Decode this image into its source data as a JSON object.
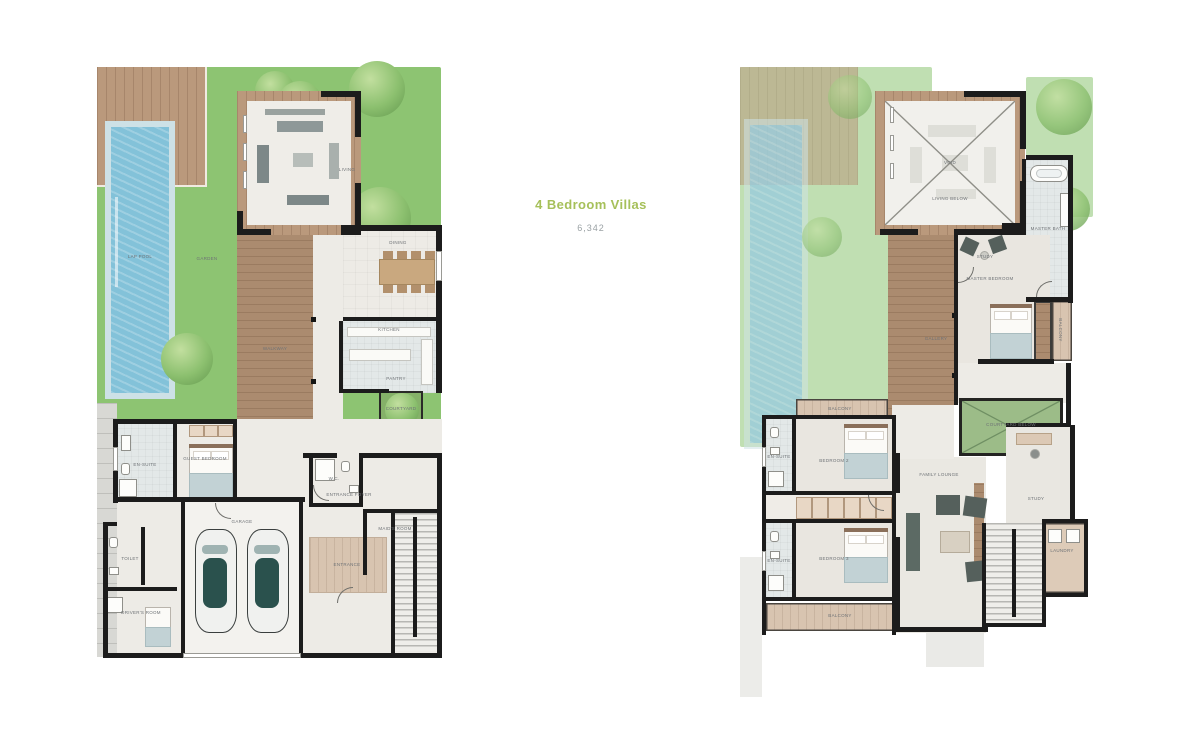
{
  "header": {
    "title": "4 Bedroom Villas",
    "subtitle": "6,342"
  },
  "colors": {
    "page": "#ffffff",
    "accent": "#a6c05a",
    "sublabel": "#9aa1a4",
    "label": "#6e7276",
    "garden": "#8dc472",
    "garden_faded": "#b9d8a8",
    "pool": "#83c2d9",
    "pool_rim": "#cde1e6",
    "wood": "#ba997c",
    "wood_dark": "#ab8b6f",
    "wall": "#1c1c1c",
    "floor": "#edebe6",
    "floor_cool": "#e3e8e8",
    "tan": "#d8c4b0",
    "court": "#85b169",
    "car_roof": "#2a514d"
  },
  "plans": [
    {
      "id": "plan-ground",
      "name": "ground-floor-plan",
      "labels": [
        {
          "text": "LAP POOL",
          "x": 12.5,
          "y": 32.0
        },
        {
          "text": "GARDEN",
          "x": 31.9,
          "y": 32.3
        },
        {
          "text": "LIVING",
          "x": 72.5,
          "y": 17.3
        },
        {
          "text": "DINING",
          "x": 87.2,
          "y": 29.6
        },
        {
          "text": "KITCHEN",
          "x": 84.6,
          "y": 44.3
        },
        {
          "text": "PANTRY",
          "x": 86.7,
          "y": 52.5
        },
        {
          "text": "COURTYARD",
          "x": 88.1,
          "y": 57.6
        },
        {
          "text": "WALKWAY",
          "x": 51.6,
          "y": 47.5
        },
        {
          "text": "GUEST BEDROOM",
          "x": 31.3,
          "y": 66.0
        },
        {
          "text": "EN-SUITE",
          "x": 13.9,
          "y": 67.0
        },
        {
          "text": "GARAGE",
          "x": 42.0,
          "y": 76.6
        },
        {
          "text": "ENTRANCE FOYER",
          "x": 73.0,
          "y": 72.1
        },
        {
          "text": "ENTRANCE",
          "x": 72.5,
          "y": 83.8
        },
        {
          "text": "W.C.",
          "x": 68.7,
          "y": 69.4
        },
        {
          "text": "MAID'S ROOM",
          "x": 86.4,
          "y": 77.8
        },
        {
          "text": "TOILET",
          "x": 9.6,
          "y": 82.8
        },
        {
          "text": "DRIVER'S ROOM",
          "x": 12.8,
          "y": 91.9
        }
      ]
    },
    {
      "id": "plan-first",
      "name": "first-floor-plan",
      "labels": [
        {
          "text": "VOID",
          "x": 59.5,
          "y": 16.2
        },
        {
          "text": "LIVING BELOW",
          "x": 59.5,
          "y": 22.2
        },
        {
          "text": "MASTER BATH",
          "x": 87.3,
          "y": 27.3
        },
        {
          "text": "STUDY",
          "x": 69.4,
          "y": 32.0
        },
        {
          "text": "MASTER BEDROOM",
          "x": 70.8,
          "y": 35.7
        },
        {
          "text": "BALCONY",
          "x": 90.7,
          "y": 44.3,
          "rot": 90
        },
        {
          "text": "GALLERY",
          "x": 55.5,
          "y": 45.8
        },
        {
          "text": "COURTYARD BELOW",
          "x": 76.8,
          "y": 60.3
        },
        {
          "text": "BALCONY",
          "x": 28.3,
          "y": 57.6
        },
        {
          "text": "BEDROOM 2",
          "x": 26.6,
          "y": 66.3
        },
        {
          "text": "EN-SUITE",
          "x": 11.0,
          "y": 65.7
        },
        {
          "text": "BEDROOM 3",
          "x": 26.6,
          "y": 82.8
        },
        {
          "text": "EN-SUITE",
          "x": 11.0,
          "y": 83.2
        },
        {
          "text": "FAMILY LOUNGE",
          "x": 56.4,
          "y": 68.7
        },
        {
          "text": "STUDY",
          "x": 83.9,
          "y": 72.7
        },
        {
          "text": "LAUNDRY",
          "x": 91.2,
          "y": 81.5
        },
        {
          "text": "BALCONY",
          "x": 28.3,
          "y": 92.4
        }
      ]
    }
  ]
}
